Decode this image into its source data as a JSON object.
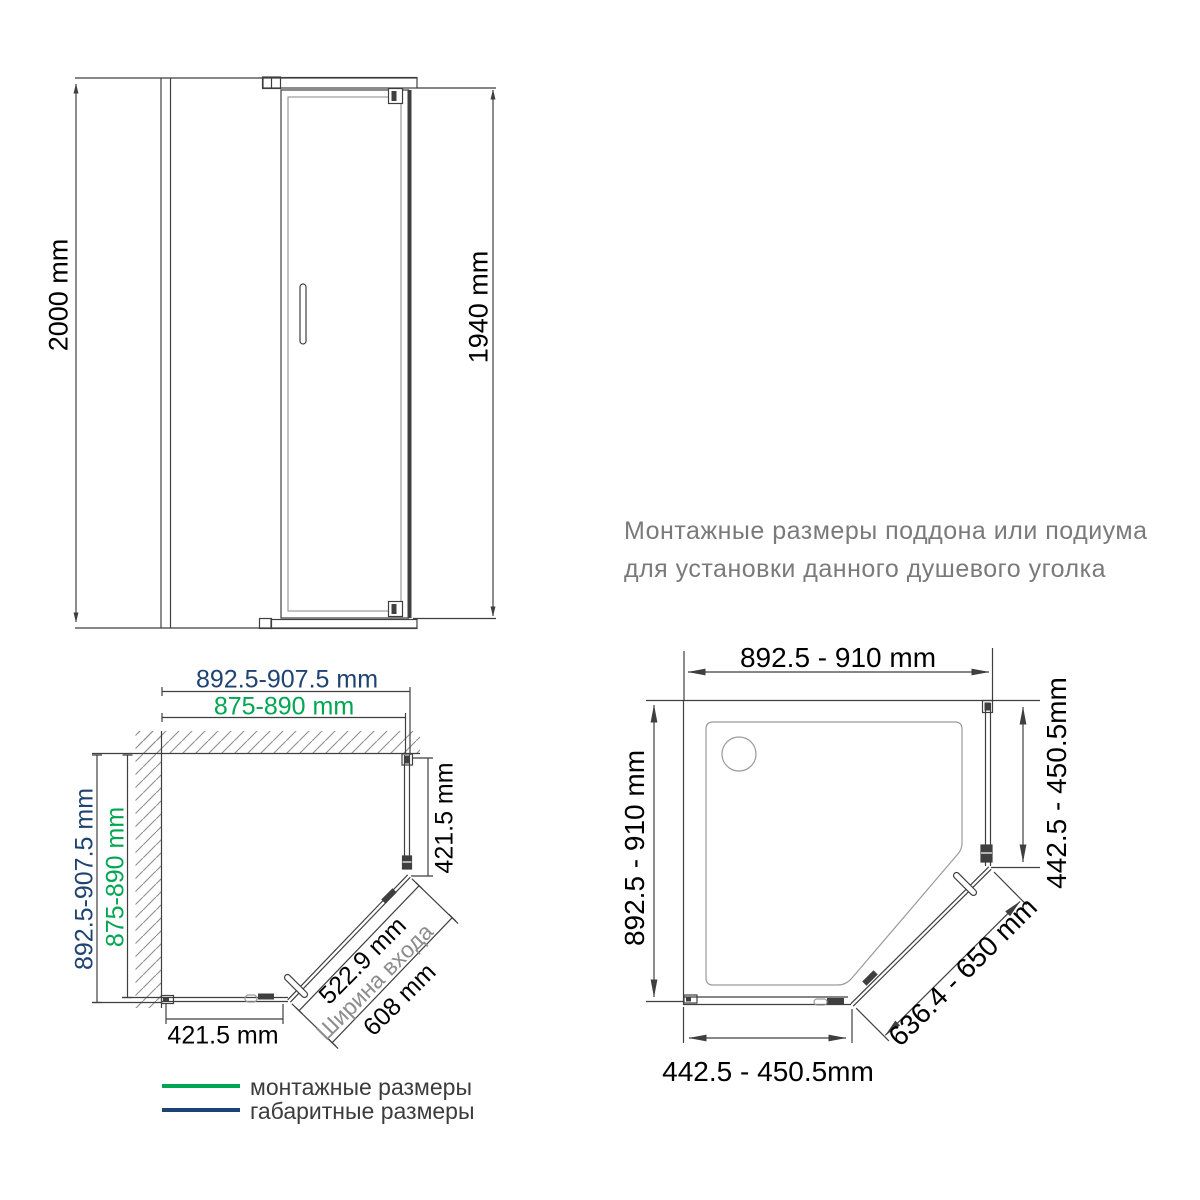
{
  "title": {
    "line1": "Монтажные размеры поддона или подиума",
    "line2": "для установки данного душевого уголка"
  },
  "elevation": {
    "overall_height": "2000 mm",
    "door_height": "1940 mm"
  },
  "plan_left": {
    "top_overall_width": "892.5-907.5 mm",
    "top_mounting_width": "875-890 mm",
    "left_overall_depth": "892.5-907.5 mm",
    "left_mounting_depth": "875-890 mm",
    "right_panel": "421.5 mm",
    "bottom_panel": "421.5 mm",
    "entrance_width": "522.9 mm",
    "entrance_label": "Ширина входа",
    "door_diagonal": "608 mm"
  },
  "plan_right": {
    "top_width": "892.5 - 910 mm",
    "left_depth": "892.5 - 910 mm",
    "right_side": "442.5 - 450.5mm",
    "bottom_side": "442.5 - 450.5mm",
    "diagonal": "636.4 - 650 mm"
  },
  "legend": {
    "mounting": {
      "label": "монтажные размеры",
      "color": "#00a651"
    },
    "overall": {
      "label": "габаритные размеры",
      "color": "#1e4272"
    }
  },
  "colors": {
    "mounting_green": "#00a651",
    "overall_navy": "#1e4272",
    "line_dark": "#3f3f3f",
    "line_gray": "#9a9a9a",
    "title_gray": "#7a7a7a"
  }
}
